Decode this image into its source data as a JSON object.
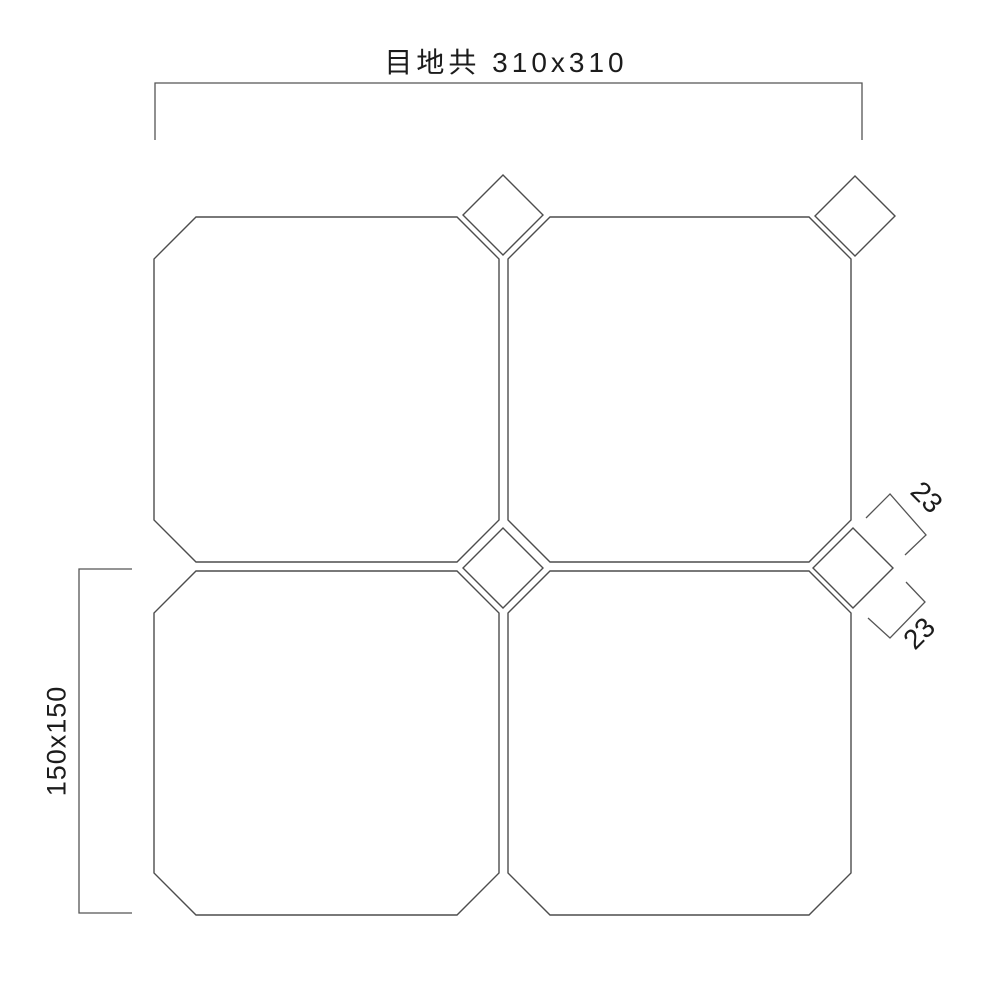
{
  "drawing": {
    "description": "tile layout dimension drawing, 2x2 octagon tiles with diamond corner inserts",
    "annotations": {
      "overall_dimension": {
        "label": "目地共 310x310"
      },
      "tile_dimension": {
        "label": "150x150"
      },
      "insert_dimension_upper": {
        "label": "23"
      },
      "insert_dimension_lower": {
        "label": "23"
      }
    },
    "colors": {
      "background": "#ffffff",
      "line": "#4d4d4d",
      "text": "#1c1c1c"
    }
  }
}
